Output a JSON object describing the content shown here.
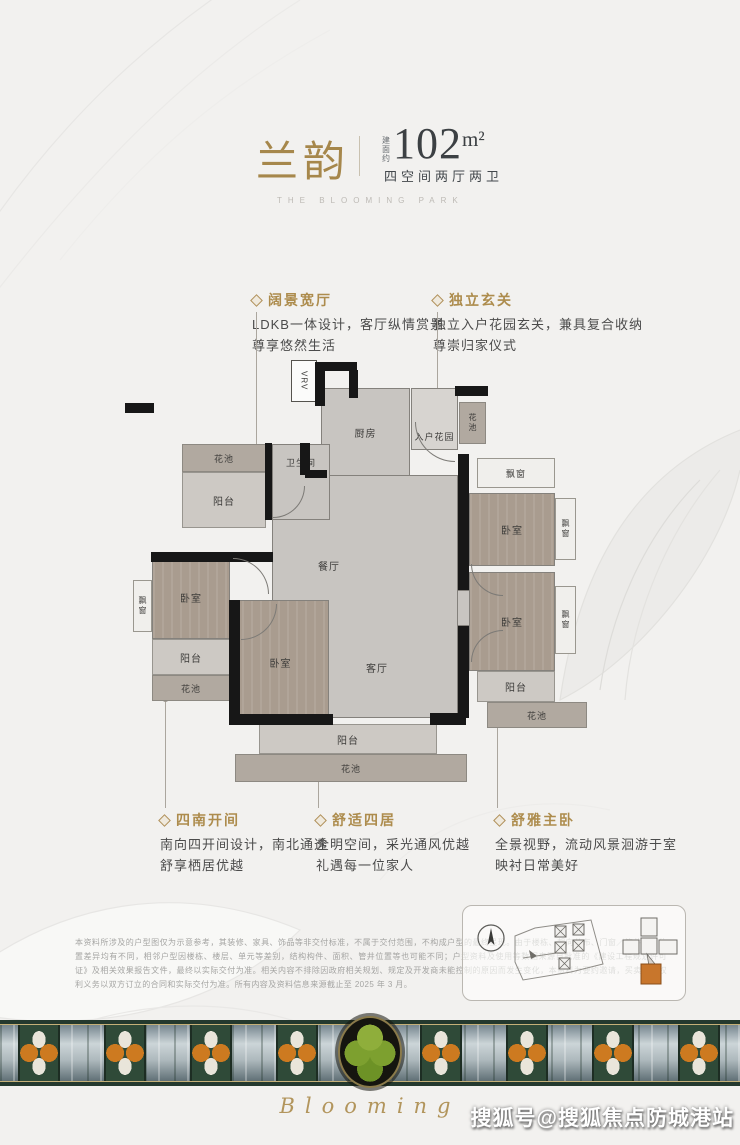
{
  "header": {
    "title": "兰韵",
    "area_prefix": "建面约",
    "area_number": "102",
    "area_unit": "m²",
    "spec": "四空间两厅两卫",
    "subtitle": "THE BLOOMING PARK"
  },
  "callouts": [
    {
      "title": "阔景宽厅",
      "line1": "LDKB一体设计，客厅纵情赏景",
      "line2": "尊享悠然生活"
    },
    {
      "title": "独立玄关",
      "line1": "独立入户花园玄关，兼具复合收纳",
      "line2": "尊崇归家仪式"
    },
    {
      "title": "四南开间",
      "line1": "南向四开间设计，南北通透",
      "line2": "舒享栖居优越"
    },
    {
      "title": "舒适四居",
      "line1": "全明空间，采光通风优越",
      "line2": "礼遇每一位家人"
    },
    {
      "title": "舒雅主卧",
      "line1": "全景视野，流动风景洄游于室",
      "line2": "映衬日常美好"
    }
  ],
  "floorplan": {
    "labels": {
      "vrv": "VRV",
      "kitchen": "厨房",
      "entry_garden": "入户花园",
      "bathroom": "卫生间",
      "dining": "餐厅",
      "living": "客厅",
      "bedroom": "卧室",
      "balcony": "阳台",
      "flower_bed": "花池",
      "bay_window": "飘窗"
    }
  },
  "disclaimer": {
    "text": "本资料所涉及的户型图仅为示意参考，其装修、家具、饰品等非交付标准，不属于交付范围，不构成户型的最终呈现。由于楼栋、朝向分布、门窗／管井等的位置差异均有不同，相邻户型因楼栋、楼层、单元等差别，结构构件、面积、管井位置等也可能不同；户型资料及使用等数据来源自批准的《建设工程规划许可证》及相关效果报告文件，最终以实际交付为准。相关内容不排除因政府相关规划、规定及开发商未能控制的原因而发生变化，本资料为要约邀请，买卖双方权利义务以双方订立的合同和实际交付为准。所有内容及资料信息来源截止至 2025 年 3 月。"
  },
  "footer": {
    "script_text": "Blooming",
    "watermark": "搜狐号@搜狐焦点防城港站"
  },
  "colors": {
    "gold": "#a6874b",
    "headline_dark": "#3c4043",
    "wall": "#171717",
    "wood_floor": "#a99c8f",
    "tile_floor": "#c8c5c1",
    "accent_orange": "#cd7a20",
    "band_green": "#2f4a38"
  }
}
